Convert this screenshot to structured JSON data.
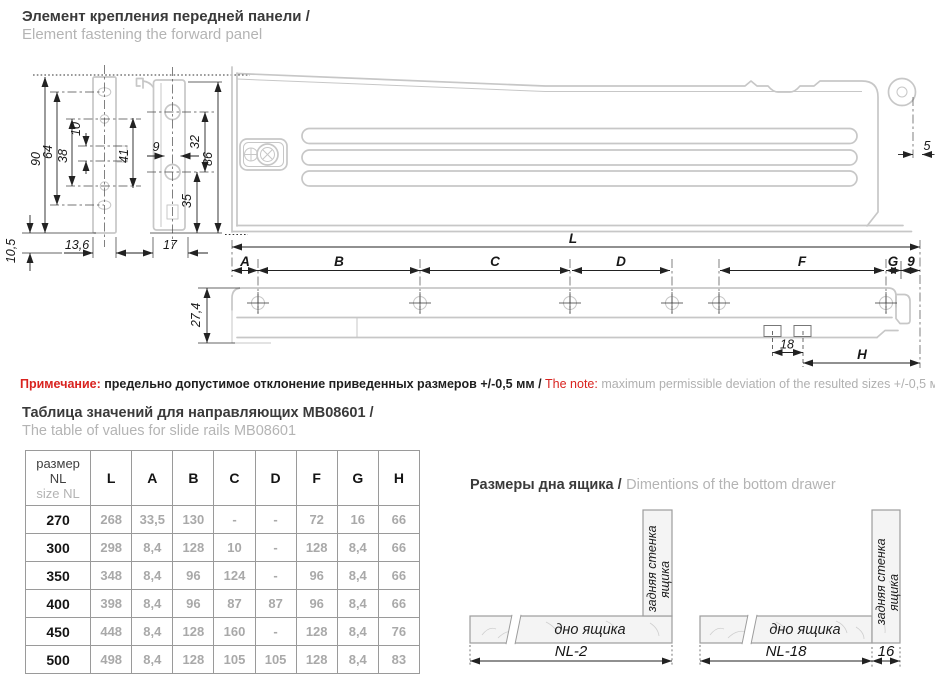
{
  "header": {
    "title_ru": "Элемент крепления передней панели /",
    "title_en": "Element fastening the forward panel"
  },
  "front_view": {
    "d90": "90",
    "d64": "64",
    "d38": "38",
    "d10": "10",
    "d41": "41",
    "d105": "10,5",
    "d136": "13,6",
    "d9": "9",
    "d32": "32",
    "d86": "86",
    "d35": "35",
    "d17": "17"
  },
  "panel_view": {
    "d5": "5"
  },
  "rail_view": {
    "L": "L",
    "A": "A",
    "B": "B",
    "C": "C",
    "D": "D",
    "F": "F",
    "G": "G",
    "d9": "9",
    "d274": "27,4",
    "d18": "18",
    "H": "H"
  },
  "note": {
    "label_ru": "Примечание: ",
    "text_ru": "предельно допустимое отклонение приведенных размеров +/-0,5 мм / ",
    "label_en": "The note: ",
    "text_en": "maximum permissible deviation of the resulted sizes +/-0,5 мм"
  },
  "table_section": {
    "title_ru": "Таблица значений для направляющих MB08601 /",
    "title_en": "The table of values for slide rails MB08601",
    "header_col": {
      "line1": "размер",
      "line2": "NL",
      "line3": "size NL"
    },
    "columns": [
      "L",
      "A",
      "B",
      "C",
      "D",
      "F",
      "G",
      "H"
    ],
    "rows": [
      {
        "nl": "270",
        "v": [
          "268",
          "33,5",
          "130",
          "-",
          "-",
          "72",
          "16",
          "66"
        ]
      },
      {
        "nl": "300",
        "v": [
          "298",
          "8,4",
          "128",
          "10",
          "-",
          "128",
          "8,4",
          "66"
        ]
      },
      {
        "nl": "350",
        "v": [
          "348",
          "8,4",
          "96",
          "124",
          "-",
          "96",
          "8,4",
          "66"
        ]
      },
      {
        "nl": "400",
        "v": [
          "398",
          "8,4",
          "96",
          "87",
          "87",
          "96",
          "8,4",
          "66"
        ]
      },
      {
        "nl": "450",
        "v": [
          "448",
          "8,4",
          "128",
          "160",
          "-",
          "128",
          "8,4",
          "76"
        ]
      },
      {
        "nl": "500",
        "v": [
          "498",
          "8,4",
          "128",
          "105",
          "105",
          "128",
          "8,4",
          "83"
        ]
      }
    ]
  },
  "drawer_section": {
    "title_ru": "Размеры дна ящика /",
    "title_en": "Dimentions of the bottom drawer",
    "bottom_label": "дно ящика",
    "back_label_1": "задняя стенка",
    "back_label_2": "ящика",
    "dim_left": "NL-2",
    "dim_mid": "NL-18",
    "dim_16": "16"
  },
  "colors": {
    "accent_red": "#d9231f",
    "text_dark": "#1f1f1f",
    "text_gray": "#b0b0b0",
    "outline_gray": "#c7c7c7"
  }
}
